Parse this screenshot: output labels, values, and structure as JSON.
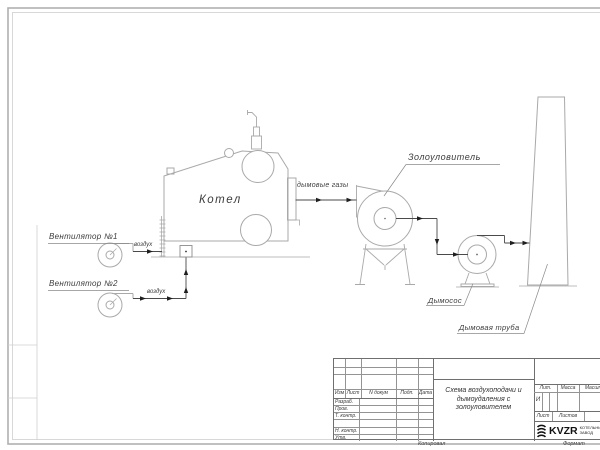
{
  "drawing": {
    "fan1_label": "Вентилятор №1",
    "fan2_label": "Вентилятор №2",
    "air1_label": "воздух",
    "air2_label": "воздух",
    "boiler_label": "Котел",
    "flue_gas_label": "дымовые газы",
    "ash_catcher_label": "Золоуловитель",
    "exhauster_label": "Дымосос",
    "chimney_label": "Дымовая труба"
  },
  "title_block": {
    "title_line1": "Схема воздухоподачи и",
    "title_line2": "дымоудаления с",
    "title_line3": "золоуловителем",
    "col_izm": "Изм",
    "col_list": "Лист",
    "col_ndokum": "N докум",
    "col_podp": "Подп.",
    "col_data": "Дата",
    "row_razrab": "Разраб.",
    "row_prov": "Пров.",
    "row_tkontr": "Т. контр.",
    "row_nkontr": "Н. контр.",
    "row_utv": "Утв.",
    "lit_label": "Лит.",
    "lit_value": "И",
    "massa_label": "Масса",
    "masshtab_label": "Масштаб",
    "list_label": "Лист",
    "listov_label": "Листов",
    "logo_text": "KVZR",
    "org_line1": "КОТЕЛЬНЫЙ",
    "org_line2": "ЗАВОД",
    "kopiroval_label": "Копировал",
    "format_label": "Формат"
  },
  "colors": {
    "equipment_line": "#a9a9a9",
    "flow_line": "#4a4a4a",
    "arrow_fill": "#1f1f1f",
    "frame_line": "#b8b8b8",
    "text": "#3a3a3a"
  }
}
